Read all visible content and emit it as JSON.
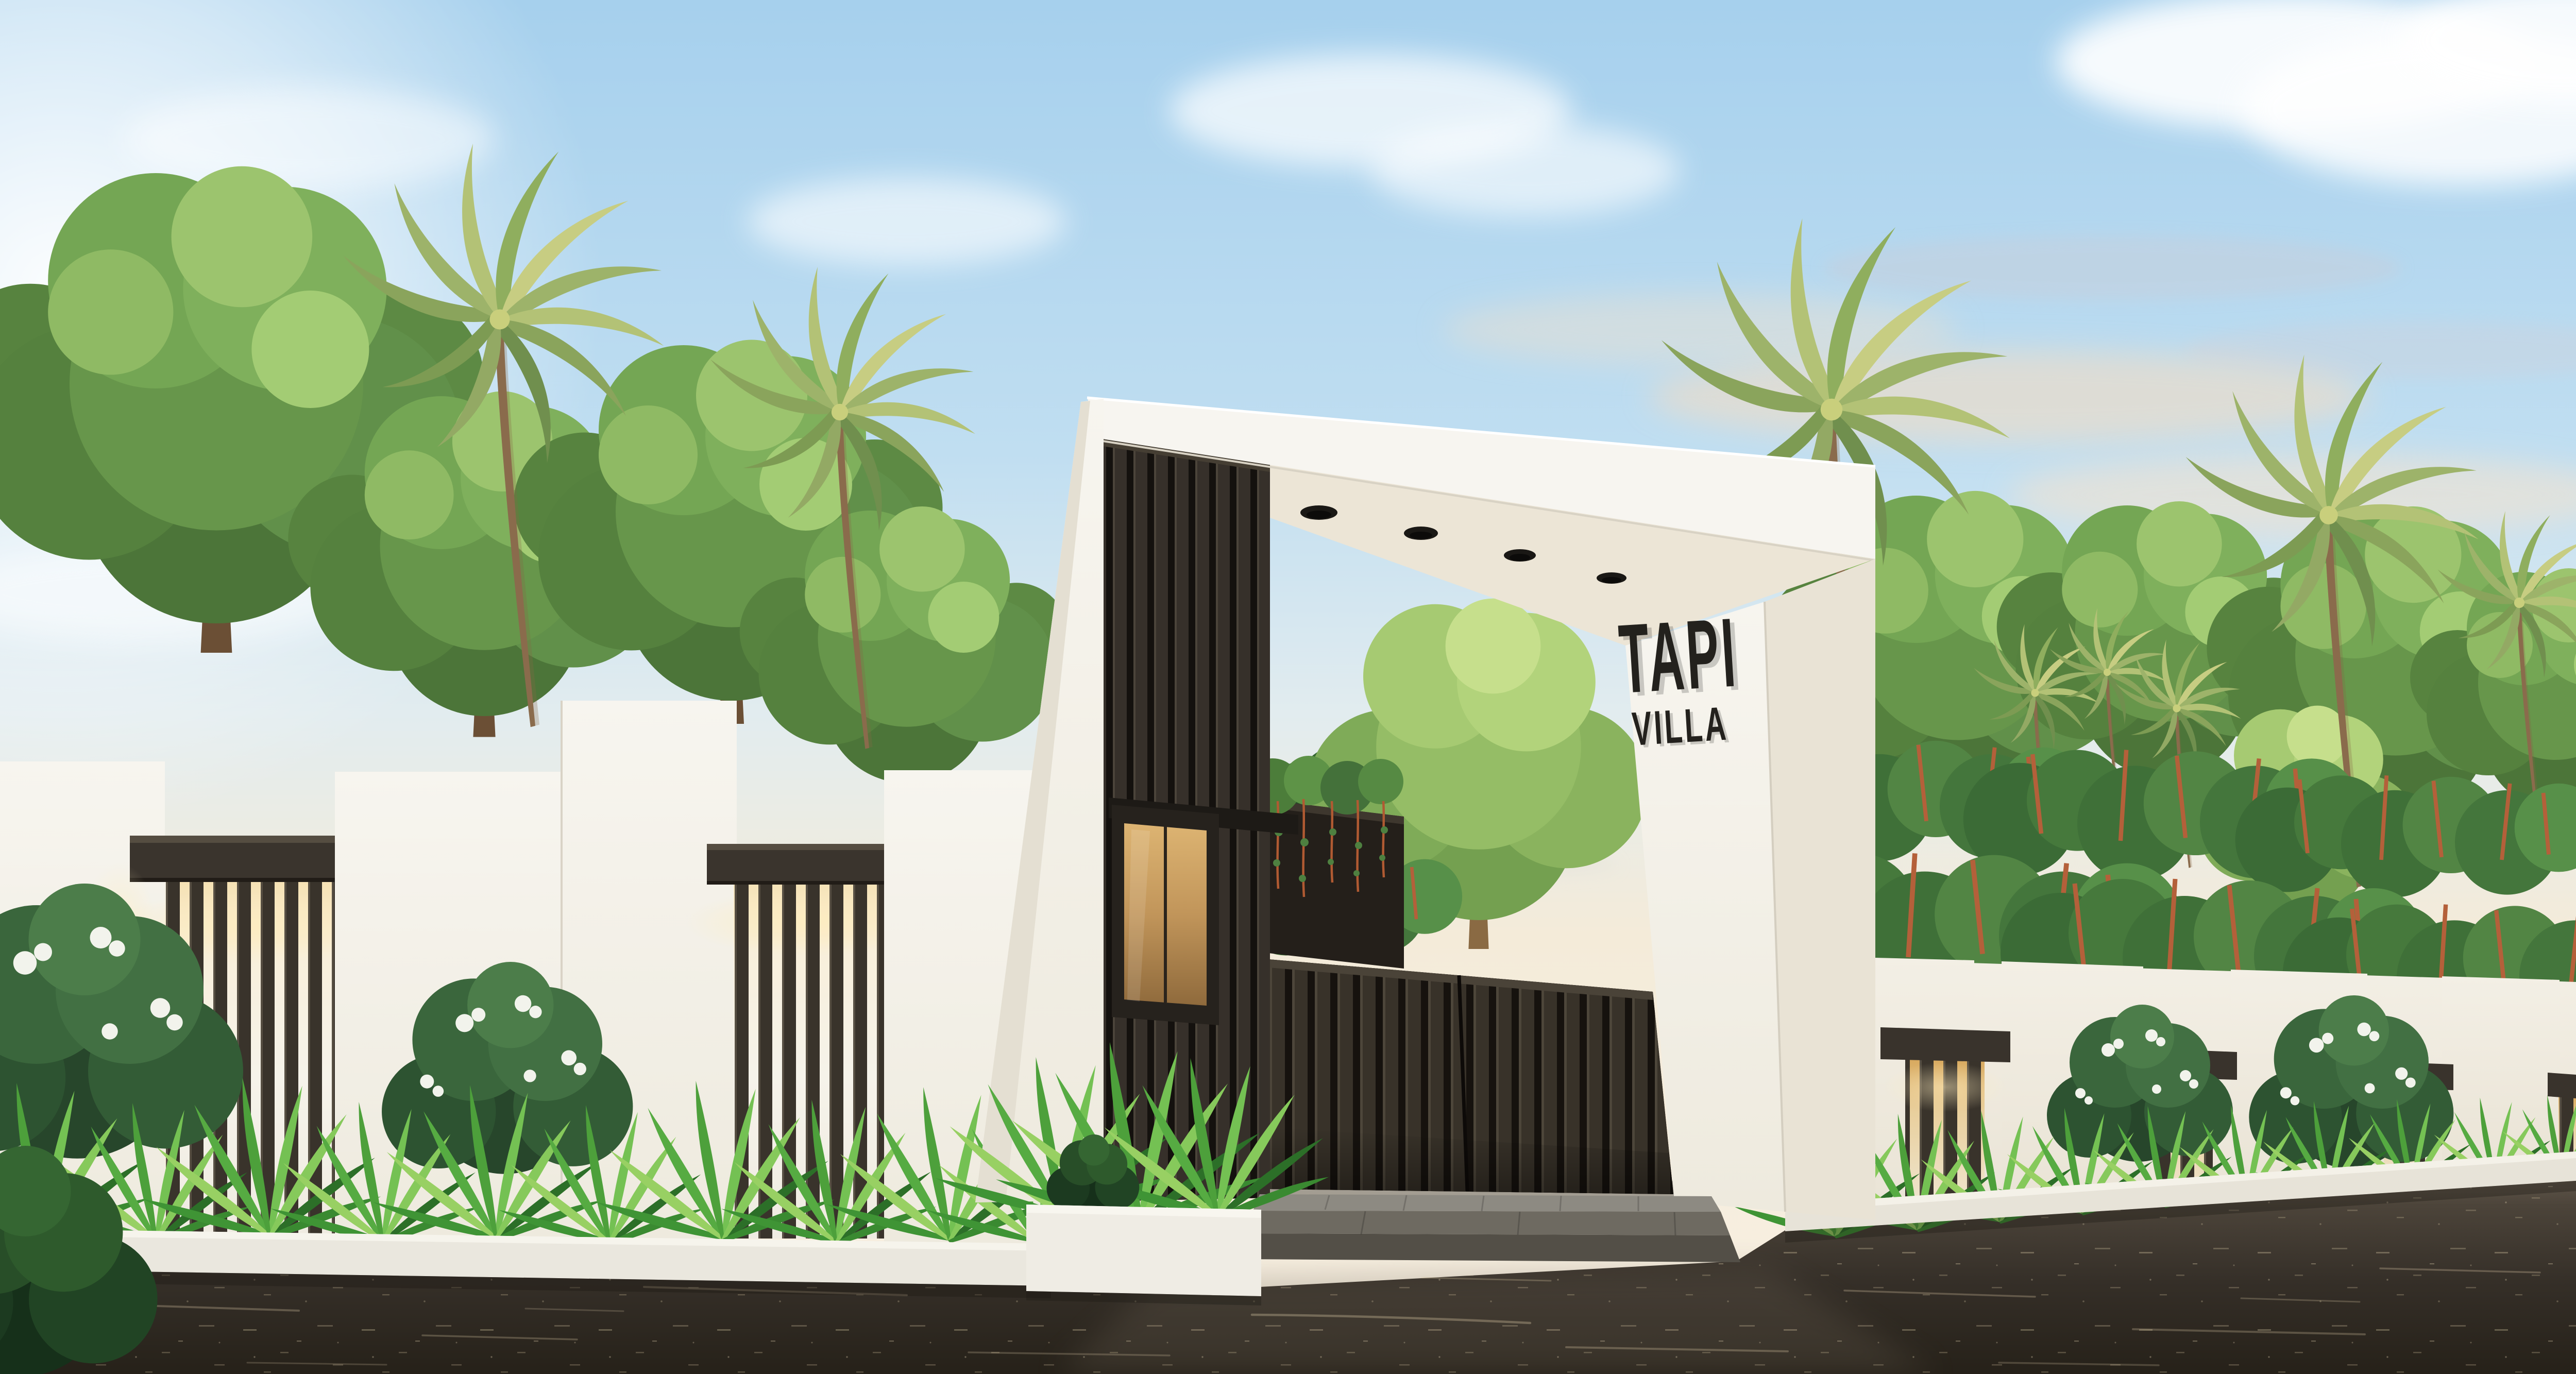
{
  "meta": {
    "scene_kind": "architectural-exterior-render",
    "subject": "modern villa entrance gate with slatted compound wall",
    "time_of_day": "golden-hour"
  },
  "sign": {
    "line1": "TAPI",
    "line2": "VILLA",
    "letter_color": "#23211d"
  },
  "gate": {
    "downlight_count": 4,
    "has_guard_window": true,
    "door_style": "dark vertical slats"
  },
  "walls": {
    "left_slat_modules": 2,
    "right_slat_modules": 4,
    "base_planter": "continuous white planter with foliage"
  },
  "palette": {
    "sky_top": "#a6d0ed",
    "sky_horizon": "#f6eedd",
    "sun_glow": "#ffffff",
    "wall_white": "#f5f3ec",
    "slat_dark": "#37312a",
    "header_cap": "#3a342d",
    "gate_door": "#2a2520",
    "glass_amber": "#c79e5c",
    "road": "#37302a",
    "foliage": "#6f9e4e",
    "palm": "#aebf6e",
    "planter_white": "#eae7de"
  }
}
